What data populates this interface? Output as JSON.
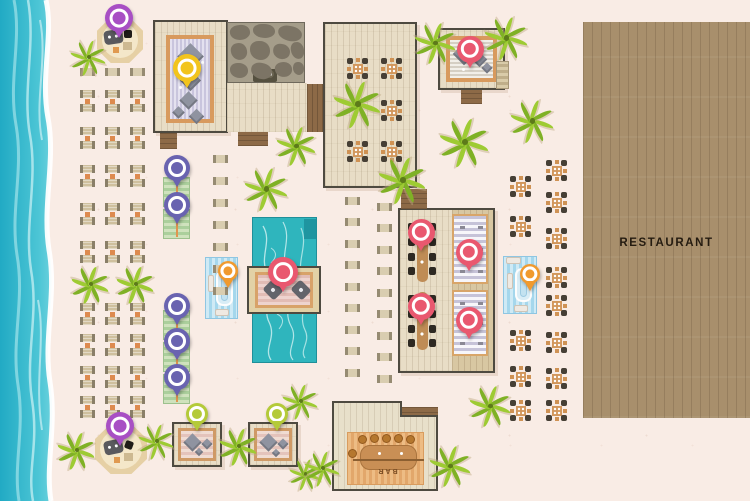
{
  "map": {
    "labels": {
      "restaurant": "RESTAURANT",
      "bar": "BAR"
    },
    "palette": {
      "ocean": "#3fbfd2",
      "sand": "#f9ece5",
      "pool": "#2fb5bd",
      "deck_light": "#e8ddc6",
      "deck_restaurant": "#a88f6c",
      "pin_pink": "#e9586f",
      "pin_purple": "#a84fc4",
      "pin_indigo": "#6963b0",
      "pin_orange": "#f09a2e",
      "pin_lime": "#b4ca39",
      "pin_yellow": "#f2c41d"
    },
    "pins": [
      {
        "name": "hut-north",
        "color": "#a84fc4",
        "x": 119,
        "y": 18,
        "size": 28
      },
      {
        "name": "spa-deck-north",
        "color": "#f2c41d",
        "x": 187,
        "y": 68,
        "size": 28
      },
      {
        "name": "spa-deck-northeast",
        "color": "#e9586f",
        "x": 470,
        "y": 49,
        "size": 27
      },
      {
        "name": "daybed-row-1",
        "color": "#6963b0",
        "x": 177,
        "y": 168,
        "size": 26
      },
      {
        "name": "daybed-row-2",
        "color": "#6963b0",
        "x": 177,
        "y": 205,
        "size": 26
      },
      {
        "name": "daybed-row-3",
        "color": "#6963b0",
        "x": 177,
        "y": 306,
        "size": 26
      },
      {
        "name": "daybed-row-4",
        "color": "#6963b0",
        "x": 177,
        "y": 341,
        "size": 26
      },
      {
        "name": "daybed-row-5",
        "color": "#6963b0",
        "x": 177,
        "y": 377,
        "size": 26
      },
      {
        "name": "pool-platform",
        "color": "#e9586f",
        "x": 283,
        "y": 272,
        "size": 30
      },
      {
        "name": "cabana-west",
        "color": "#f09a2e",
        "x": 228,
        "y": 271,
        "size": 20
      },
      {
        "name": "cabana-east",
        "color": "#f09a2e",
        "x": 530,
        "y": 274,
        "size": 20
      },
      {
        "name": "dining-table-east-1",
        "color": "#e9586f",
        "x": 421,
        "y": 232,
        "size": 27
      },
      {
        "name": "dining-table-east-2",
        "color": "#e9586f",
        "x": 421,
        "y": 306,
        "size": 27
      },
      {
        "name": "lounge-mat-east-1",
        "color": "#e9586f",
        "x": 469,
        "y": 252,
        "size": 27
      },
      {
        "name": "lounge-mat-east-2",
        "color": "#e9586f",
        "x": 469,
        "y": 320,
        "size": 27
      },
      {
        "name": "hut-south",
        "color": "#a84fc4",
        "x": 120,
        "y": 426,
        "size": 28
      },
      {
        "name": "massage-deck-west",
        "color": "#b4ca39",
        "x": 197,
        "y": 414,
        "size": 22
      },
      {
        "name": "massage-deck-east",
        "color": "#b4ca39",
        "x": 277,
        "y": 414,
        "size": 22
      }
    ]
  }
}
